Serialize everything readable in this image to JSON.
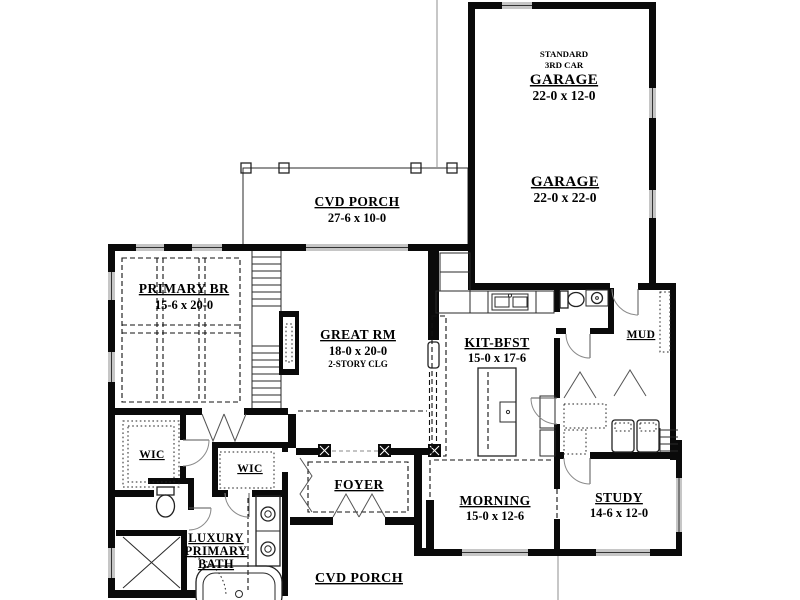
{
  "plan": {
    "type": "single-family house first floor plan",
    "colors": {
      "wall": "#0a0a0a",
      "window": "#c6c6c6",
      "paper": "#ffffff"
    }
  },
  "rooms": {
    "garage3": {
      "line1": "STANDARD",
      "line2": "3RD CAR",
      "title": "GARAGE",
      "dims": "22-0 x 12-0"
    },
    "garage": {
      "title": "GARAGE",
      "dims": "22-0 x 22-0"
    },
    "porch_top": {
      "title": "CVD PORCH",
      "dims": "27-6 x 10-0"
    },
    "primary": {
      "title": "PRIMARY BR",
      "dims": "15-6 x 20-0"
    },
    "great": {
      "title": "GREAT RM",
      "dims": "18-0 x 20-0",
      "note": "2-STORY CLG"
    },
    "kitchen": {
      "title": "KIT-BFST",
      "dims": "15-0 x 17-6"
    },
    "mud": {
      "title": "MUD"
    },
    "morning": {
      "title": "MORNING",
      "dims": "15-0 x 12-6"
    },
    "study": {
      "title": "STUDY",
      "dims": "14-6 x 12-0"
    },
    "wic1": {
      "title": "WIC"
    },
    "wic2": {
      "title": "WIC"
    },
    "bath": {
      "line1": "LUXURY",
      "line2": "PRIMARY",
      "line3": "BATH"
    },
    "foyer": {
      "title": "FOYER"
    },
    "porch_bottom": {
      "title": "CVD PORCH"
    }
  }
}
